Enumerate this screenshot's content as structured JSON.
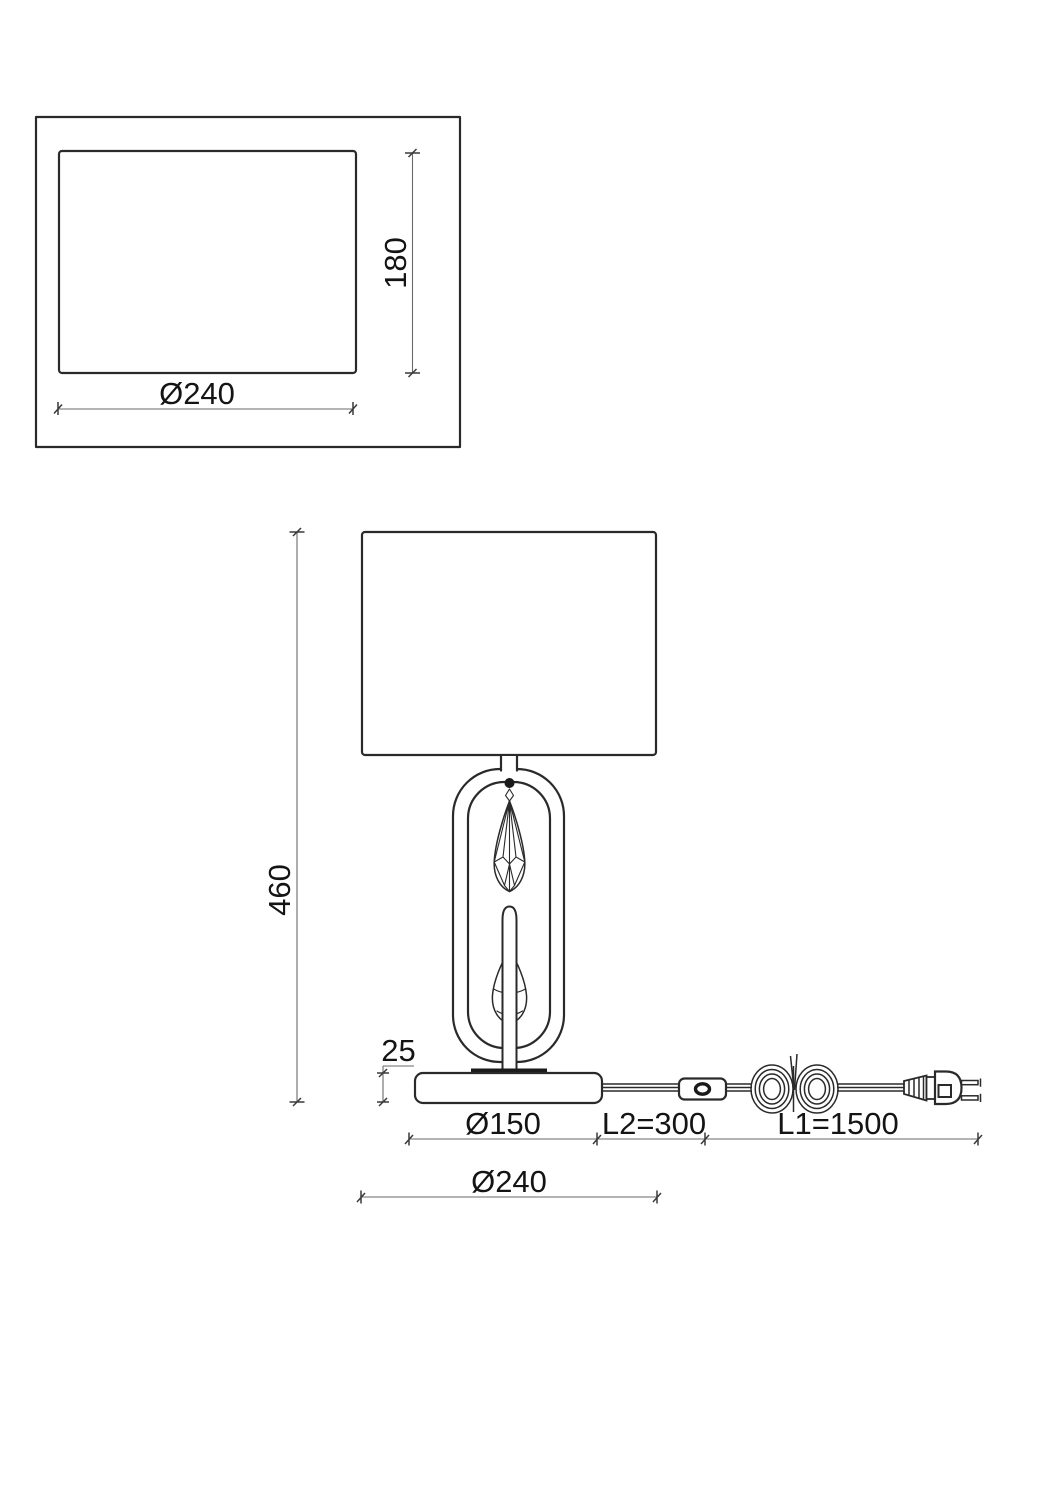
{
  "colors": {
    "background": "#ffffff",
    "object_line": "#2a2a2a",
    "dimension_line": "#6a6a6a",
    "text": "#141414"
  },
  "top_view": {
    "width_label": "Ø240",
    "depth_label": "180"
  },
  "front_view": {
    "height_label": "460",
    "base_height_label": "25",
    "base_width_label": "Ø150",
    "shade_width_label": "Ø240",
    "switch_cord_label": "L2=300",
    "plug_cord_label": "L1=1500"
  }
}
